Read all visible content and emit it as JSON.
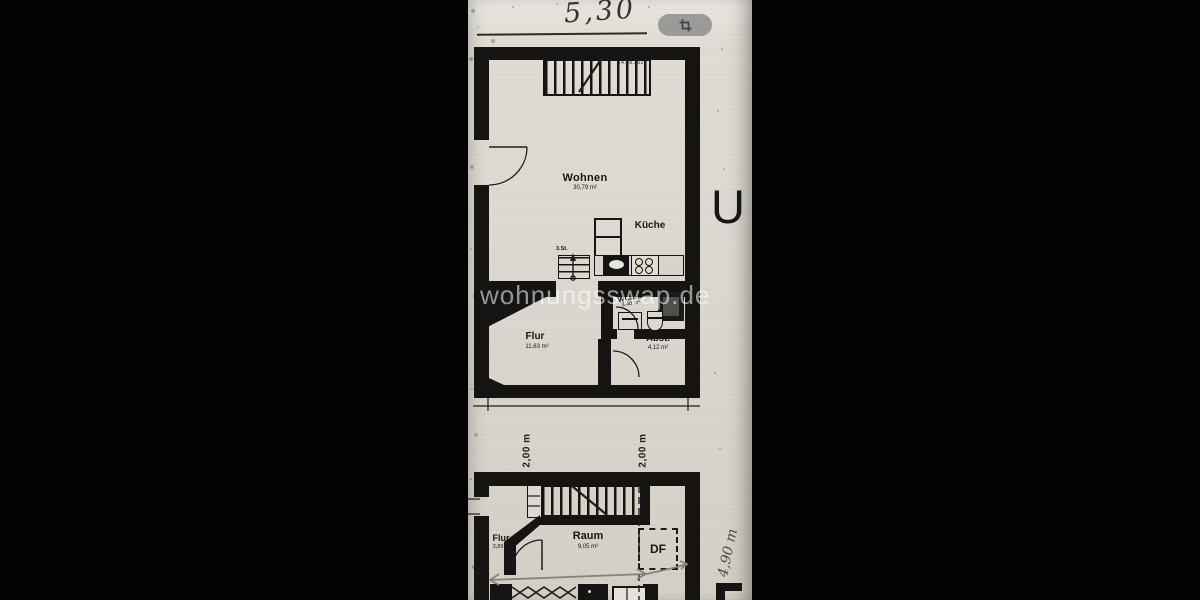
{
  "toolbar": {
    "scale_note": "5,30",
    "crop_button": "crop"
  },
  "watermark": {
    "text": "wohnungsswap.de"
  },
  "margin": {
    "section_letter": "U",
    "width_note": "4,90 m"
  },
  "upper_plan": {
    "stamp": "14.08.2022",
    "steps_label": "3.St.",
    "rooms": {
      "wohnen": {
        "name": "Wohnen",
        "area": "30,79 m²"
      },
      "kueche": {
        "name": "Küche"
      },
      "flur": {
        "name": "Flur",
        "area": "11,63 m²"
      },
      "wc": {
        "name": "WC/Du",
        "area": "3,40 m²"
      },
      "abst": {
        "name": "Abst.",
        "area": "4,12 m²"
      }
    }
  },
  "dimensions": {
    "left": "2,00 m",
    "right": "2,00 m"
  },
  "lower_plan": {
    "roof_window": "DF",
    "rooms": {
      "flur": {
        "name": "Flur",
        "area": "3,89 m²"
      },
      "raum": {
        "name": "Raum",
        "area": "9,05 m²"
      }
    }
  },
  "colors": {
    "paper": "#dcd8d1",
    "wall_ink": "#161412",
    "crop_button_bg": "#9c9b99",
    "pencil": "#8a8375",
    "watermark": "rgba(255,255,255,0.55)"
  }
}
